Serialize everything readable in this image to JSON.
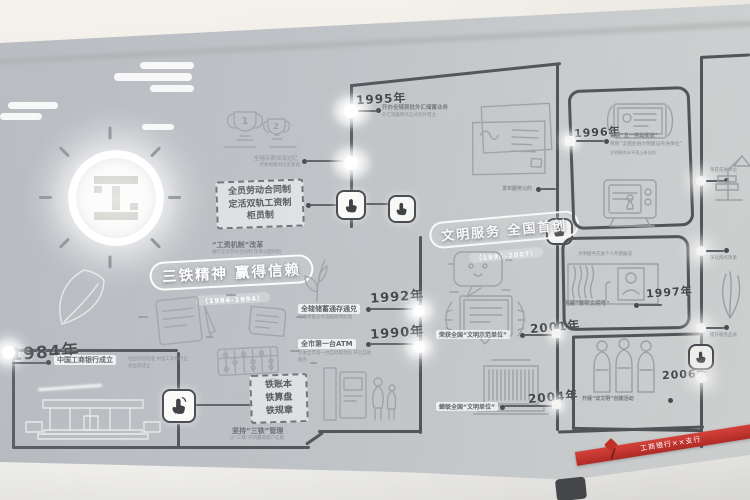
{
  "era1": {
    "title": "三铁精神 赢得信赖",
    "subtitle": "（1984-1994）"
  },
  "era2": {
    "title": "文明服务 全国首创",
    "subtitle": "（1995-2007）"
  },
  "events": {
    "y1984": {
      "year": "1984年",
      "caption": "中国工商银行成立",
      "note": "经国务院批准 中国工商银行正式挂牌成立"
    },
    "y1990": {
      "year": "1990年",
      "caption": "全市第一台ATM",
      "note": "引进全市第一台自动取款机 开启自助服务"
    },
    "y1992": {
      "year": "1992年",
      "caption": "全辖储蓄通存通兑",
      "note": "实现储蓄业务电脑联网处理"
    },
    "y1995": {
      "year": "1995年",
      "caption": "开办全辖首批外汇储蓄业务",
      "note": "外汇储蓄网点正式对外营业"
    },
    "y1996": {
      "year": "1996年",
      "caption1": "荣获“五一劳动奖状”",
      "caption2": "荣获“全国金融文明建设先进单位”",
      "note": "文明服务水平再上新台阶"
    },
    "y1997": {
      "year": "1997年",
      "caption": "创建“青年文明号”"
    },
    "y2001": {
      "year": "2001年",
      "caption": "荣获全国“文明示范单位”"
    },
    "y2004": {
      "year": "2004年",
      "caption": "蝉联全国“文明单位”"
    },
    "y2006": {
      "year": "2006年",
      "caption": "开展“双文明”创建活动"
    }
  },
  "boxes": {
    "reform": {
      "line1": "全员劳动合同制",
      "line2": "定活双轨工资制",
      "line3": "柜员制",
      "caption": "“工资机制”改革",
      "note": "推行全员劳动合同制 改革分配机制"
    },
    "three_iron": {
      "line1": "铁账本",
      "line2": "铁算盘",
      "line3": "铁规章",
      "caption": "坚持“三铁”管理",
      "note": "以“三铁”作风赢得客户信赖"
    }
  },
  "trophies": {
    "n1": "1",
    "n2": "2",
    "caption": "全辖存款双双过亿",
    "note": "存款规模创历史新高"
  },
  "letters": {
    "caption": "发布服务公约"
  },
  "portrait": {
    "caption": "文明服务先进个人专题报道"
  },
  "right_panel": {
    "cap1": "荣获先进单位",
    "cap2": "深化网点改革",
    "cap3": "提升服务品质"
  },
  "banner": {
    "text": "工商银行××支行"
  },
  "icons": {
    "touch": "☝",
    "logo": "工"
  },
  "colors": {
    "wall": "#bfc3c7",
    "line": "#54575b",
    "red": "#c0322b",
    "ink": "#4a4e52"
  }
}
